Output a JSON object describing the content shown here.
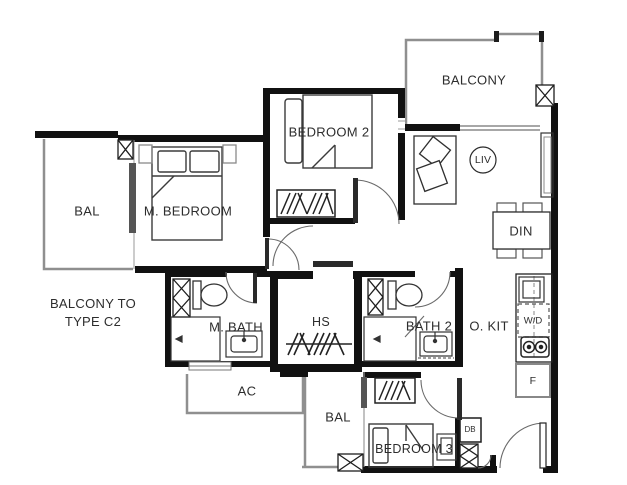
{
  "rooms": {
    "balcony_top": {
      "label": "BALCONY"
    },
    "bal_left": {
      "label": "BAL"
    },
    "m_bedroom": {
      "label": "M. BEDROOM"
    },
    "bedroom_2": {
      "label": "BEDROOM 2"
    },
    "living": {
      "label": "LIV"
    },
    "dining": {
      "label": "DIN"
    },
    "m_bath": {
      "label": "M. BATH"
    },
    "household_shelter": {
      "label": "HS"
    },
    "bath_2": {
      "label": "BATH 2"
    },
    "open_kitchen": {
      "label": "O. KIT"
    },
    "ac_ledge": {
      "label": "AC"
    },
    "bal_bottom": {
      "label": "BAL"
    },
    "bedroom_3": {
      "label": "BEDROOM 3"
    }
  },
  "appliances": {
    "washer_dryer": {
      "label": "W/D"
    },
    "fridge": {
      "label": "F"
    },
    "distribution_board": {
      "label": "DB"
    }
  },
  "notes": {
    "balcony_note_line1": "BALCONY TO",
    "balcony_note_line2": "TYPE C2"
  },
  "colors": {
    "wall": "#111111",
    "balcony_outline": "#8f8f8f",
    "text": "#2d2d2d"
  }
}
